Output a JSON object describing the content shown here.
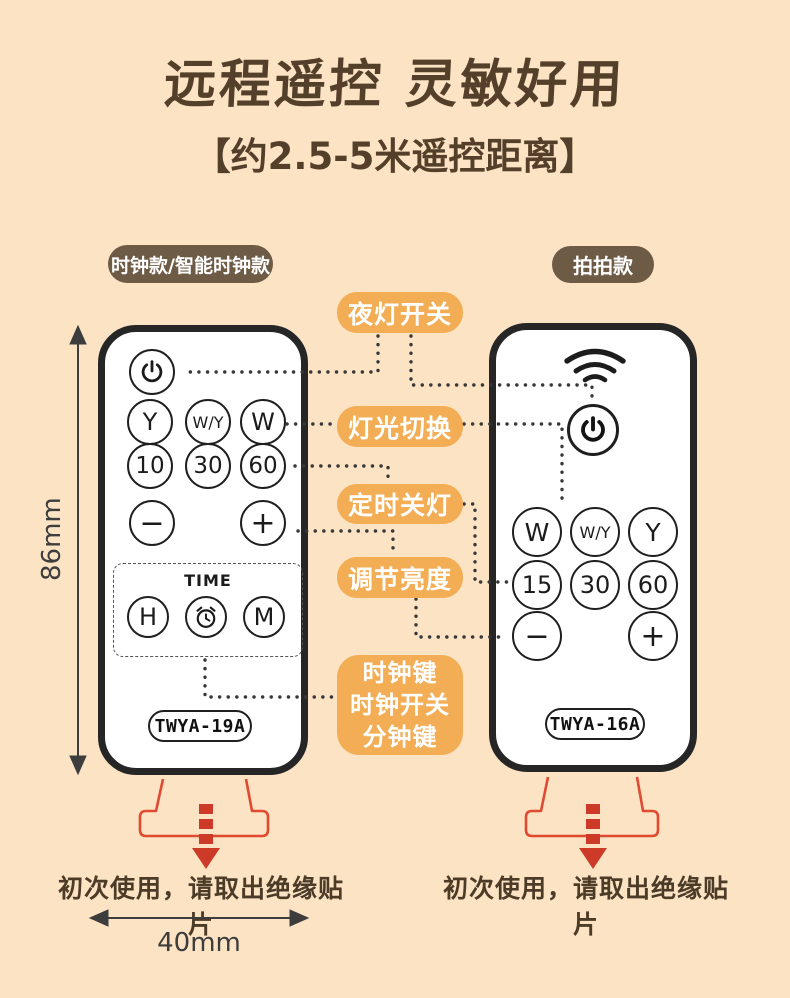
{
  "title": "远程遥控 灵敏好用",
  "subtitle": "【约2.5-5米遥控距离】",
  "colors": {
    "background": "#fbe3c4",
    "title_brown": "#54402a",
    "model_badge_brown": "#6e5b46",
    "callout_orange": "#f2ad55",
    "remote_border": "#262626",
    "accent_red": "#d8402c",
    "dotted_line": "#383838",
    "dimension_gray": "#3d3d3d"
  },
  "model_badges": {
    "left": "时钟款/智能时钟款",
    "right": "拍拍款"
  },
  "callouts": {
    "night_light_switch": "夜灯开关",
    "light_switching": "灯光切换",
    "timer_off": "定时关灯",
    "adjust_brightness": "调节亮度",
    "clock_group": [
      "时钟键",
      "时钟开关",
      "分钟键"
    ]
  },
  "left_remote": {
    "row1": [
      "Y",
      "W/Y",
      "W"
    ],
    "row2": [
      "10",
      "30",
      "60"
    ],
    "minus": "−",
    "plus": "+",
    "time_label": "TIME",
    "hour": "H",
    "minute": "M",
    "model": "TWYA-19A"
  },
  "right_remote": {
    "row1": [
      "W",
      "W/Y",
      "Y"
    ],
    "row2": [
      "15",
      "30",
      "60"
    ],
    "minus": "−",
    "plus": "+",
    "model": "TWYA-16A"
  },
  "notes": {
    "left": "初次使用，请取出绝缘贴片",
    "right": "初次使用，请取出绝缘贴片"
  },
  "dimensions": {
    "height": "86mm",
    "width": "40mm"
  }
}
